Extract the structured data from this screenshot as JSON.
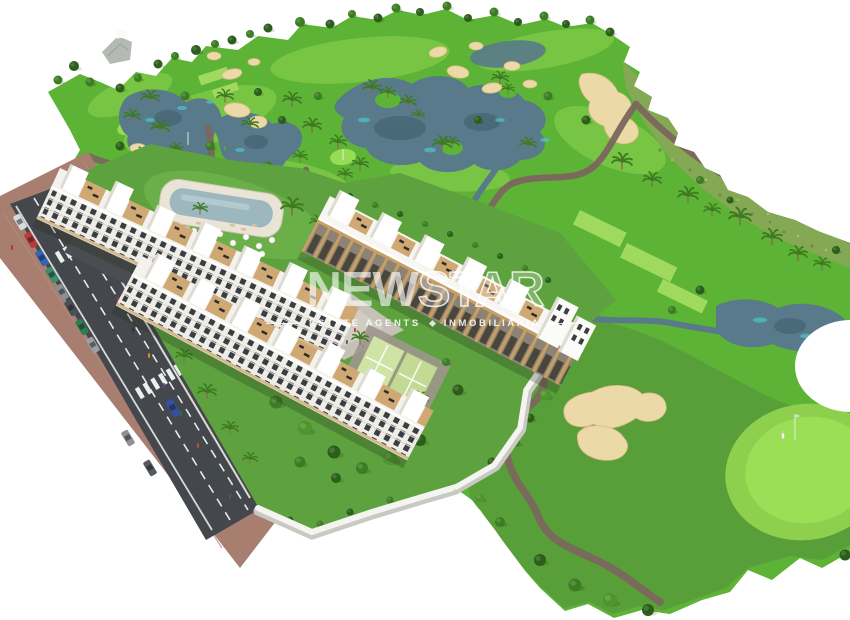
{
  "scene": {
    "description": "Aerial 3D architectural render of a white apartment complex with pool and padel courts beside a golf course with lakes, bunkers and a road with traffic"
  },
  "watermark": {
    "brand_solid": "NEW",
    "brand_outline": "STAR",
    "subtitle_left": "ESTATE AGENTS",
    "subtitle_right": "INMOBILIARIA"
  },
  "palette": {
    "fairway": "#5cb335",
    "fairway_light": "#84cb4a",
    "fairway_olive": "#579b39",
    "rough": "#85a855",
    "tee": "#9fd95e",
    "green_bright": "#9adf56",
    "green_fringe": "#8ed04e",
    "lake": "#587a8a",
    "lake_accent": "#4fc0c4",
    "sand": "#ecd9a8",
    "cart_path": "#7c675e",
    "road": "#44484c",
    "sidewalk": "#a87e70",
    "building": "#f7f6f2",
    "facade": "#efede7",
    "wood": "#c89e66",
    "terrace": "#cfa873",
    "pool_water": "#9db7bf",
    "pool_deck": "#e9e4d6",
    "plaza": "#c6c1b7",
    "padel_court": "#cfe3a4",
    "garden": "#5da23f",
    "wall": "#f4f4f0"
  },
  "vehicles": {
    "street_cars": [
      {
        "color": "#d8dadb"
      },
      {
        "color": "#b93a36"
      },
      {
        "color": "#3565b0"
      },
      {
        "color": "#3a8f6e"
      },
      {
        "color": "#8a8f94"
      },
      {
        "color": "#4a4f54"
      },
      {
        "color": "#2e7d4f"
      },
      {
        "color": "#9aa0a5"
      },
      {
        "color": "#34509e"
      },
      {
        "color": "#8e9296"
      },
      {
        "color": "#55595e"
      }
    ],
    "driveway_cars": [
      {
        "color": "#c0c2c4"
      },
      {
        "color": "#3b66aa"
      },
      {
        "color": "#a33e38"
      }
    ],
    "golf_cart_color": "#f2f2ee"
  }
}
